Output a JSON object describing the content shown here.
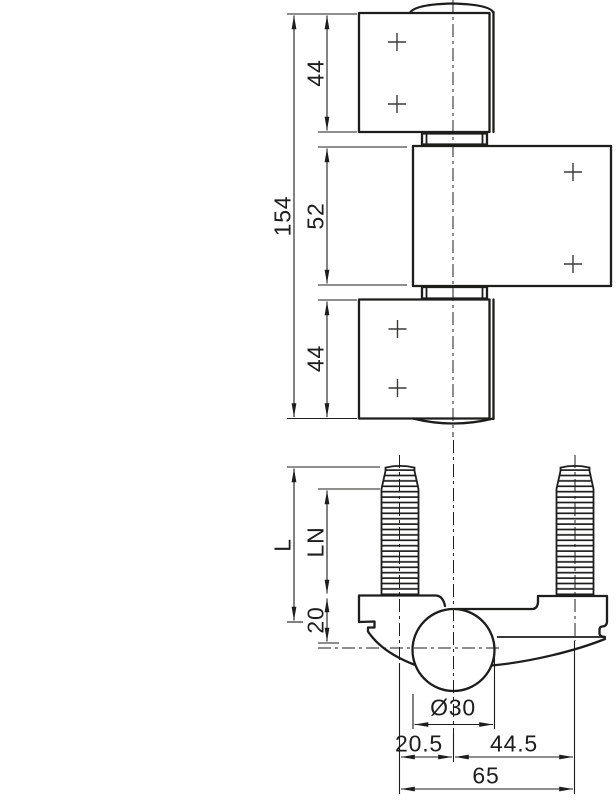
{
  "title": "Hinge technical drawing",
  "colors": {
    "line": "#1d1d1b",
    "background": "#ffffff"
  },
  "front_view": {
    "dims": {
      "total_height": "154",
      "top_leaf_height": "44",
      "middle_leaf_height": "52",
      "bottom_leaf_height": "44"
    }
  },
  "section_view": {
    "dims": {
      "stud_length": "L",
      "thread_length": "LN",
      "body_depth": "20",
      "barrel_diameter": "Ø30",
      "left_stud_offset": "20.5",
      "right_stud_offset": "44.5",
      "stud_spacing": "65"
    }
  }
}
